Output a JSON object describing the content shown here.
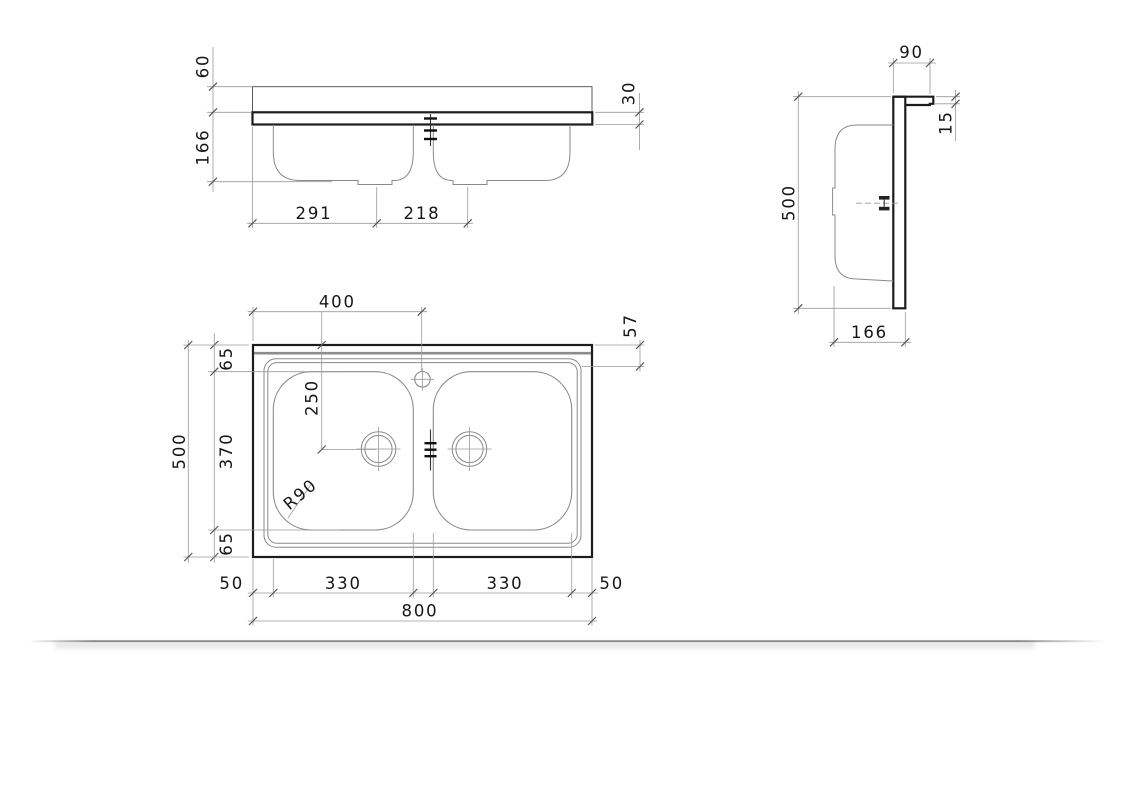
{
  "drawing": {
    "description": "Three-view dimensioned technical drawing of a double-bowl sit-on kitchen sink",
    "views": [
      "front-elevation",
      "side-section",
      "plan"
    ],
    "units": "mm",
    "line_colors": {
      "outline": "#1c1c1c",
      "thin_detail": "#8a8a8a",
      "dimension": "#9a9a9a",
      "text": "#161616"
    }
  },
  "dims": {
    "front_60": "60",
    "front_166": "166",
    "front_291": "291",
    "front_218": "218",
    "front_30": "30",
    "side_90": "90",
    "side_15": "15",
    "side_500": "500",
    "side_166": "166",
    "plan_400": "400",
    "plan_57": "57",
    "plan_65_top": "65",
    "plan_370": "370",
    "plan_65_bottom": "65",
    "plan_500": "500",
    "plan_250": "250",
    "plan_r90": "R90",
    "plan_50_left": "50",
    "plan_330_left": "330",
    "plan_330_right": "330",
    "plan_50_right": "50",
    "plan_800": "800"
  }
}
